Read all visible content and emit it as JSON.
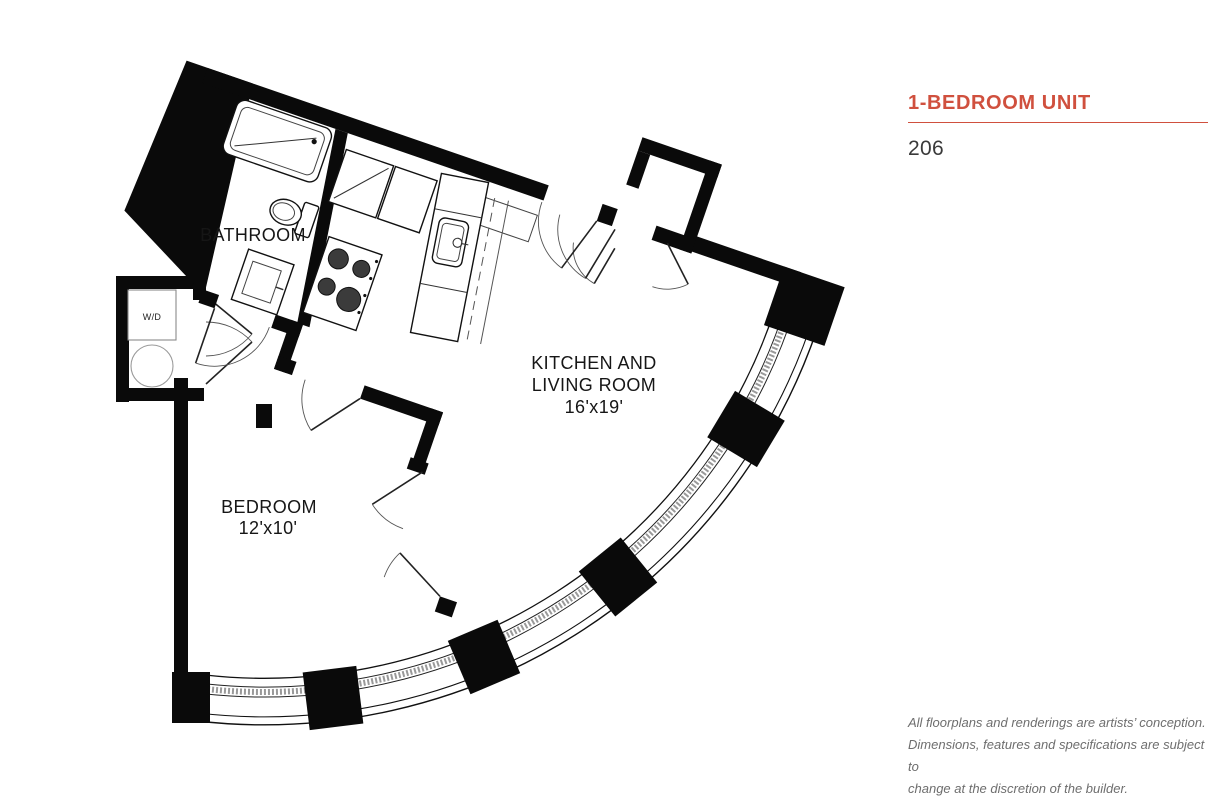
{
  "header": {
    "unit_type": "1-BEDROOM UNIT",
    "unit_number": "206",
    "accent_color": "#d0503e"
  },
  "floorplan": {
    "rooms": {
      "bathroom": {
        "label": "BATHROOM"
      },
      "kitchen_living": {
        "label_line1": "KITCHEN AND",
        "label_line2": "LIVING ROOM",
        "dimensions": "16'x19'"
      },
      "bedroom": {
        "label": "BEDROOM",
        "dimensions": "12'x10'"
      },
      "laundry": {
        "label": "W/D"
      }
    },
    "ink_color": "#0a0a0a"
  },
  "disclaimer": {
    "line1": "All floorplans and renderings are artists’ conception.",
    "line2": "Dimensions, features and specifications are subject to",
    "line3": "change at the discretion of the builder."
  }
}
